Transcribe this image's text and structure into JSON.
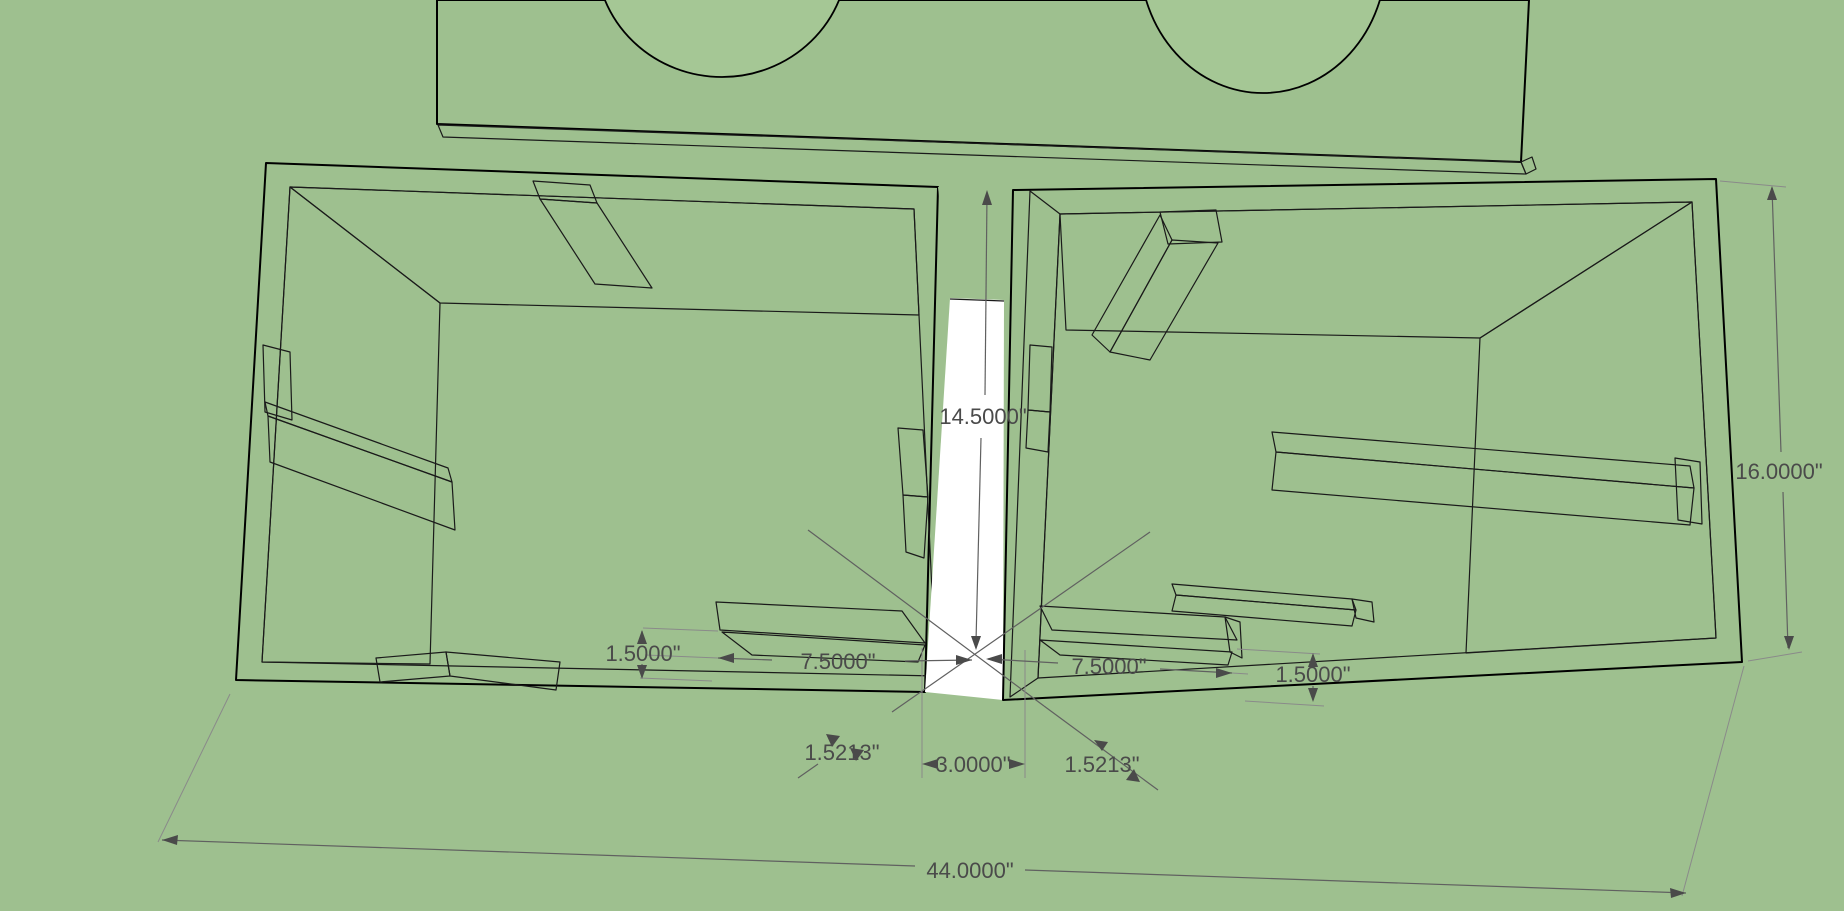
{
  "app": {
    "name": "3d-model-viewport",
    "description": "SketchUp-style 3D view of a dual-chamber speaker box with dimension annotations"
  },
  "colors": {
    "background": "#9ec08f",
    "hole_green": "#a5c795",
    "face_white": "#ffffff",
    "back_wall_gray": "#8f8f8f",
    "side_wall_dark": "#696969",
    "divider_dark": "#5f5f5f",
    "thickness_gray": "#7f7f7f",
    "bevel_gray": "#7c7c7c",
    "dim_text": "#4a4a4a"
  },
  "dims": {
    "center_height": "14.5000\"",
    "right_side_height": "16.0000\"",
    "left_thickness": "1.5000\"",
    "left_span": "7.5000\"",
    "right_span": "7.5000\"",
    "right_thickness": "1.5000\"",
    "left_diagonal": "1.5213\"",
    "center_slot": "3.0000\"",
    "right_diagonal": "1.5213\"",
    "overall_width": "44.0000\""
  }
}
